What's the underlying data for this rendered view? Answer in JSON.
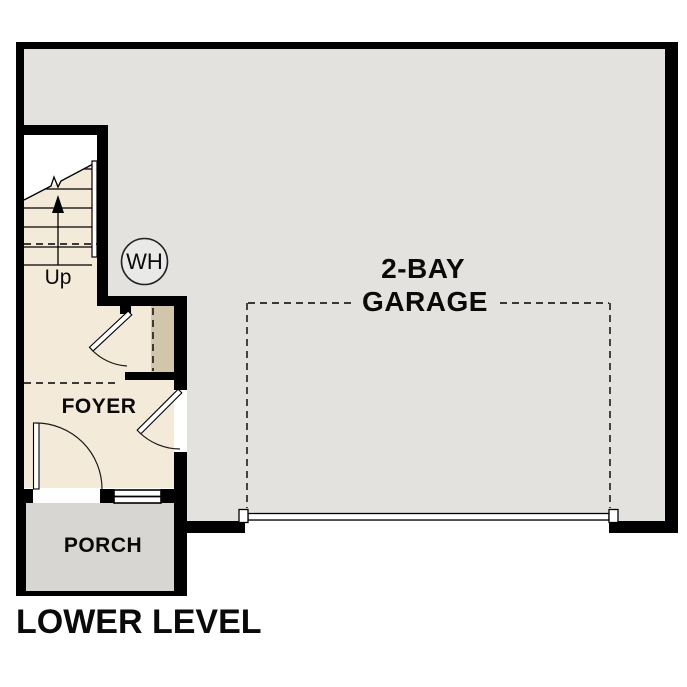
{
  "title": "LOWER LEVEL",
  "rooms": {
    "garage": {
      "label_line1": "2-BAY",
      "label_line2": "GARAGE"
    },
    "foyer": {
      "label": "FOYER"
    },
    "porch": {
      "label": "PORCH"
    }
  },
  "stairs": {
    "up_label": "Up"
  },
  "fixtures": {
    "water_heater": {
      "label": "WH"
    }
  },
  "colors": {
    "wall": "#000000",
    "garage_floor": "#e3e2df",
    "foyer_floor": "#f4ead9",
    "porch_floor": "#d7d6d2",
    "chase": "#d1c5aa",
    "water_heater_fill": "#e9eae8",
    "exterior": "#ffffff"
  }
}
